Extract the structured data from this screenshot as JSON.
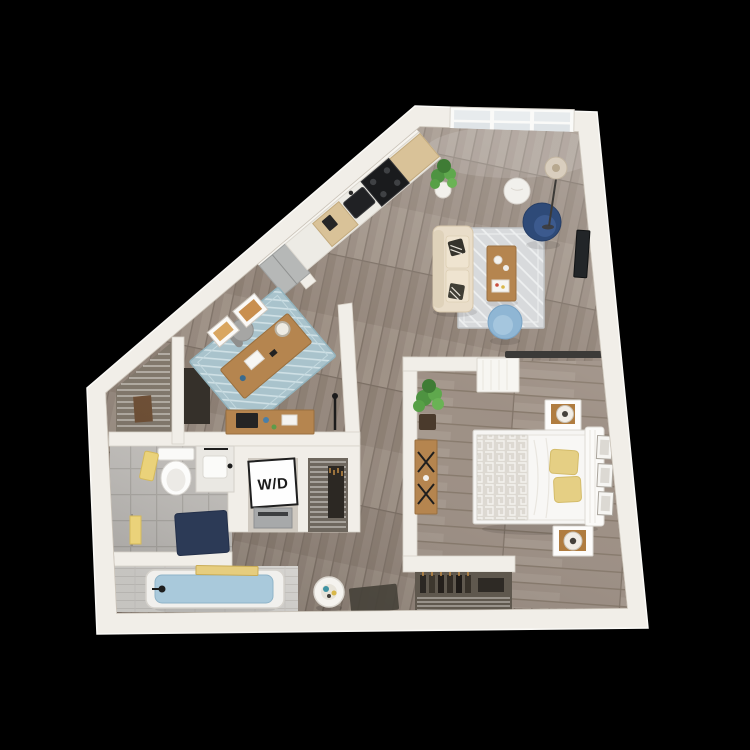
{
  "figure": {
    "type": "3D apartment floor plan render, top-down view",
    "background": "#000000"
  },
  "labels": {
    "washer_dryer": "W/D"
  },
  "palette": {
    "wall": "#f1eee8",
    "wall_shade": "#d8d2c8",
    "floor_wood": "#94867b",
    "bedroom_wood": "#9c8e83",
    "bath_tile": "#c9c6c2",
    "rug_living": "#d8dadc",
    "rug_office": "#a9c3cc",
    "sofa": "#e9ddc9",
    "coffee_table": "#b5854f",
    "armchair_navy": "#2e4a78",
    "chair_light_blue": "#8fb6d4",
    "bed_linen": "#f6f5f3",
    "pillow_yellow": "#e5cf84",
    "tub_water": "#a9c9db",
    "towel_yellow": "#ead27a",
    "bath_mat_navy": "#2c3a56",
    "plant_green": "#4e9341",
    "cabinet_wood": "#d9c298",
    "appliance_black": "#1a1b1d",
    "stainless": "#b6b8b7"
  },
  "rooms": {
    "living_room": {
      "items": [
        "sofa",
        "coffee table",
        "area rug",
        "navy accent chair",
        "light blue chair",
        "round side table",
        "floor lamp",
        "wall mounted tv",
        "picture window",
        "potted plant"
      ]
    },
    "kitchen": {
      "items": [
        "refrigerator",
        "cabinets",
        "counter",
        "sink",
        "range",
        "coffee maker"
      ]
    },
    "office": {
      "items": [
        "desk",
        "desk chair",
        "area rug",
        "wall art",
        "console table",
        "floor lamp"
      ]
    },
    "hall_closet": {
      "items": [
        "wire shelving",
        "hanging clothes"
      ]
    },
    "bathroom": {
      "items": [
        "toilet",
        "vanity sink",
        "towels",
        "bath mat",
        "bathtub",
        "bath caddy"
      ]
    },
    "laundry_closet": {
      "items": [
        "stacked washer dryer"
      ]
    },
    "linen_closet": {
      "items": [
        "wire shelving",
        "hanging clothes"
      ]
    },
    "bedroom": {
      "items": [
        "bed",
        "patterned blanket",
        "yellow pillows",
        "two nightstands",
        "table lamps",
        "wall frames",
        "console desk",
        "potted plant",
        "sliding barn door",
        "reach-in closet"
      ]
    },
    "entry": {
      "items": [
        "accent stool",
        "doormat"
      ]
    }
  }
}
